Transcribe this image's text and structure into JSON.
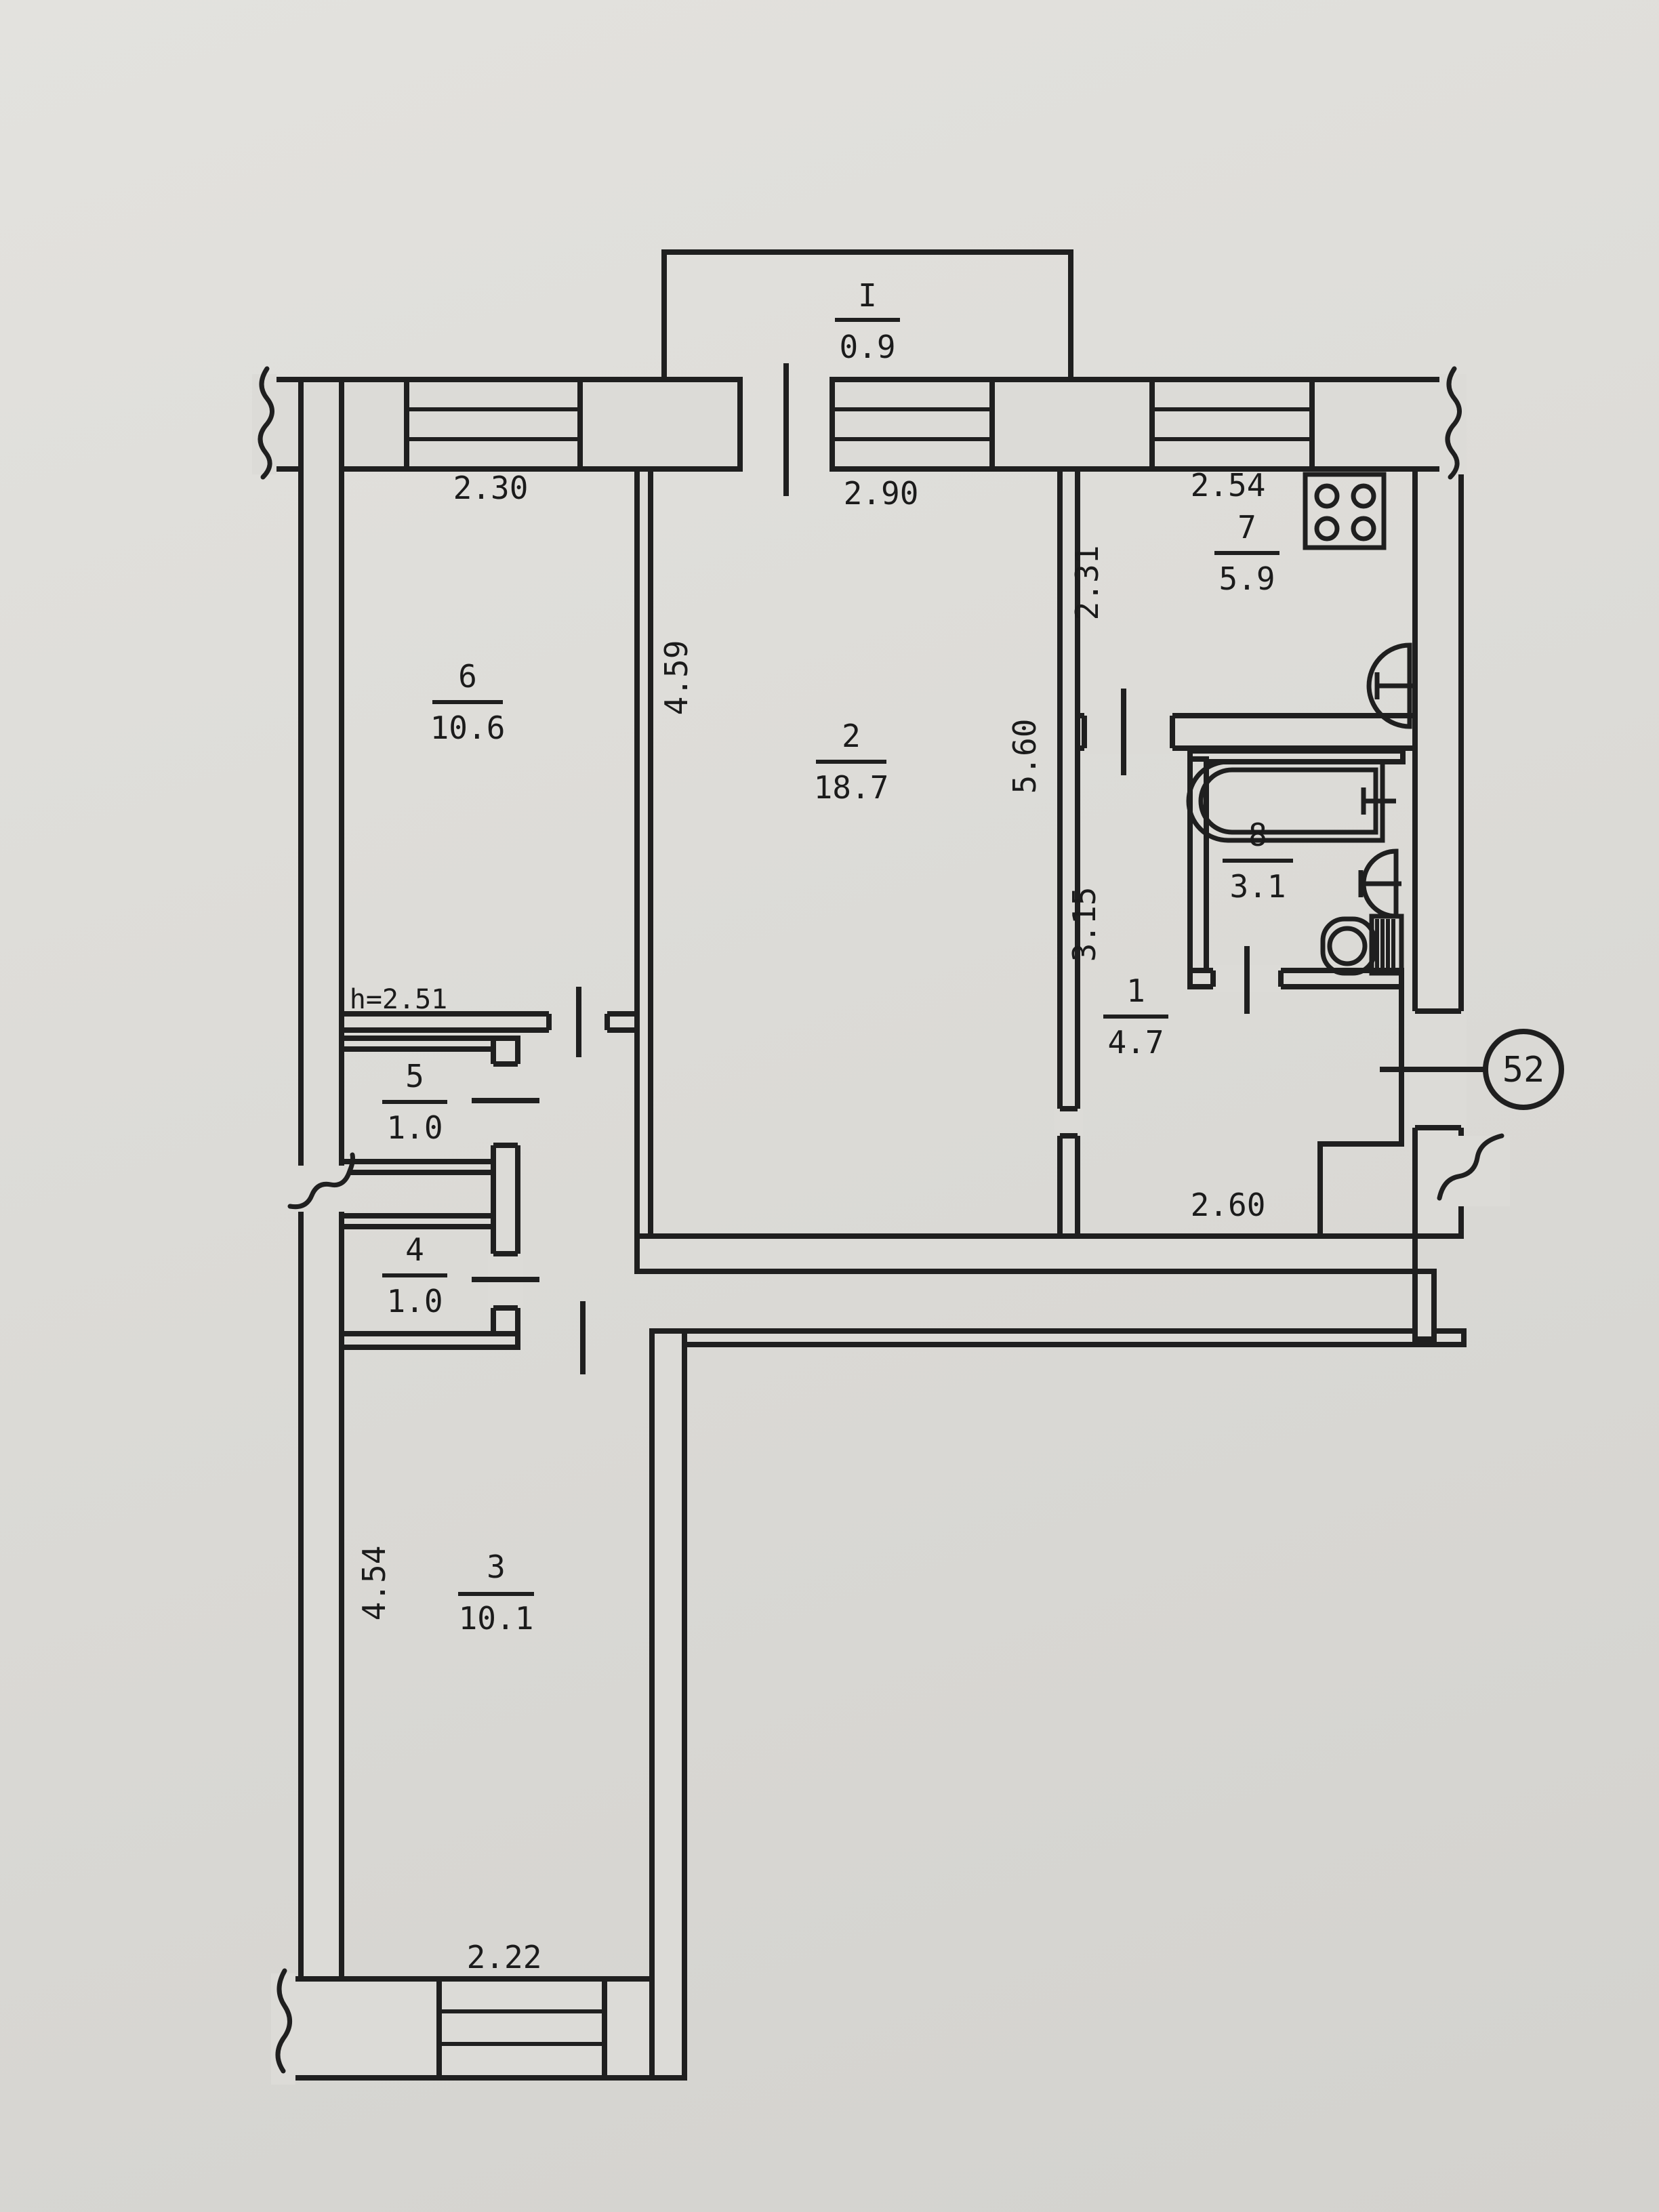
{
  "apartment_number": "52",
  "balcony": {
    "number": "I",
    "area": "0.9"
  },
  "rooms": {
    "room6": {
      "number": "6",
      "area": "10.6"
    },
    "room2": {
      "number": "2",
      "area": "18.7"
    },
    "room7": {
      "number": "7",
      "area": "5.9"
    },
    "room8": {
      "number": "8",
      "area": "3.1"
    },
    "room1": {
      "number": "1",
      "area": "4.7"
    },
    "room5": {
      "number": "5",
      "area": "1.0"
    },
    "room4": {
      "number": "4",
      "area": "1.0"
    },
    "room3": {
      "number": "3",
      "area": "10.1"
    }
  },
  "dimensions": {
    "top_left": "2.30",
    "top_middle": "2.90",
    "top_right": "2.54",
    "room6_depth": "4.59",
    "room2_depth": "5.60",
    "kitchen_depth": "2.31",
    "hall_depth": "3.15",
    "hall_width": "2.60",
    "room3_depth": "4.54",
    "room3_width": "2.22",
    "ceiling_height": "h=2.51"
  }
}
